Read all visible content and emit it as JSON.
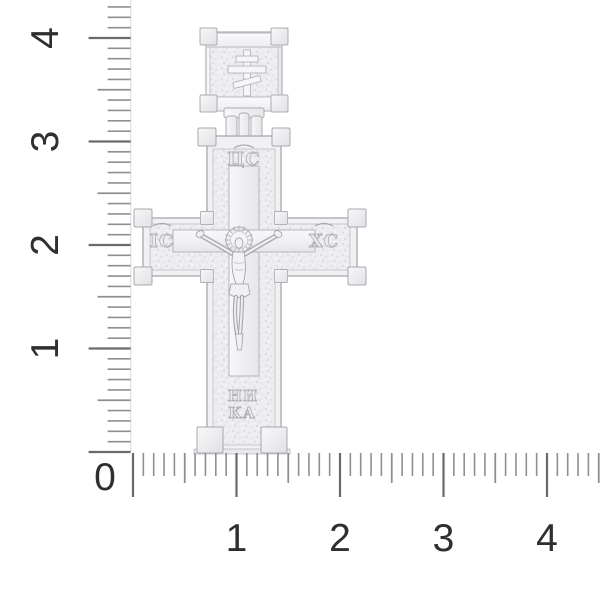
{
  "scene": {
    "background_color": "#ffffff",
    "subject_icon": "orthodox-cross-pendant"
  },
  "rulers": {
    "origin_label": "0",
    "vertical_labels": [
      "1",
      "2",
      "3",
      "4"
    ],
    "horizontal_labels": [
      "1",
      "2",
      "3",
      "4"
    ],
    "tick_color": "#8f8f93",
    "major_tick_color": "#6a6a6e",
    "edge_line_color": "#e2e2e6",
    "number_color": "#2f2f31"
  },
  "pendant": {
    "metal_color": "#f2f2f4",
    "outline_color": "#b2b2b7",
    "texture_base_color": "#ededf0",
    "inscriptions": {
      "top": "ЦС",
      "left": "ІС",
      "right": "ХС",
      "bottom_line1": "НИ",
      "bottom_line2": "КА"
    }
  }
}
